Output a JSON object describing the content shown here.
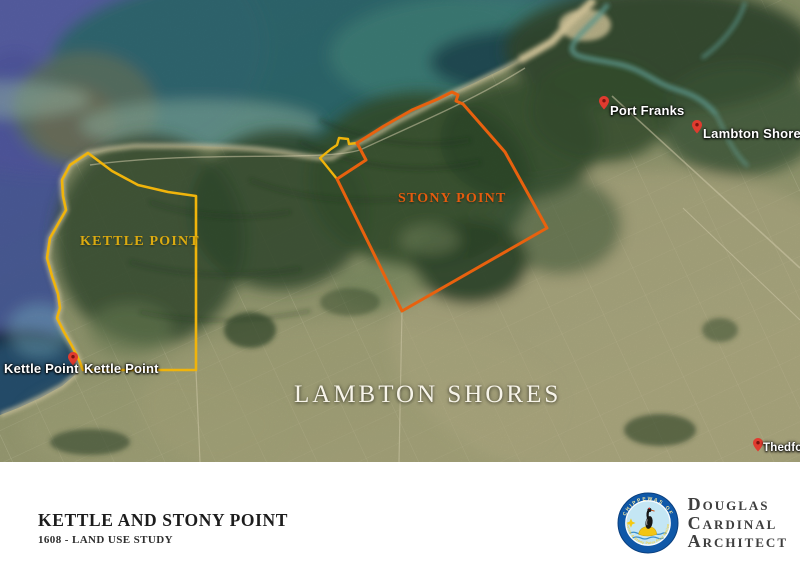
{
  "map": {
    "region_labels": [
      {
        "text": "KETTLE POINT",
        "outline_color": "#f0b40b"
      },
      {
        "text": "STONY POINT",
        "outline_color": "#e8610e"
      }
    ],
    "area_label": "LAMBTON SHORES",
    "place_labels": [
      {
        "text": "Port Franks"
      },
      {
        "text": "Lambton Shores"
      },
      {
        "text": "Thedford"
      },
      {
        "text": "Kettle Point"
      },
      {
        "text": "Kettle Point"
      }
    ],
    "pin_color": "#e03b2f"
  },
  "footer": {
    "title": "KETTLE AND STONY POINT",
    "subtitle": "1608 - LAND USE STUDY"
  },
  "brand": {
    "name_lines": [
      "Douglas",
      "Cardinal",
      "Architect"
    ],
    "badge": {
      "top_text": "CHIPPEWAS OF",
      "bottom_text": "Kettle & Stony Point First Nation",
      "ring_color": "#0f58a8",
      "accent_color": "#f3c512"
    }
  }
}
